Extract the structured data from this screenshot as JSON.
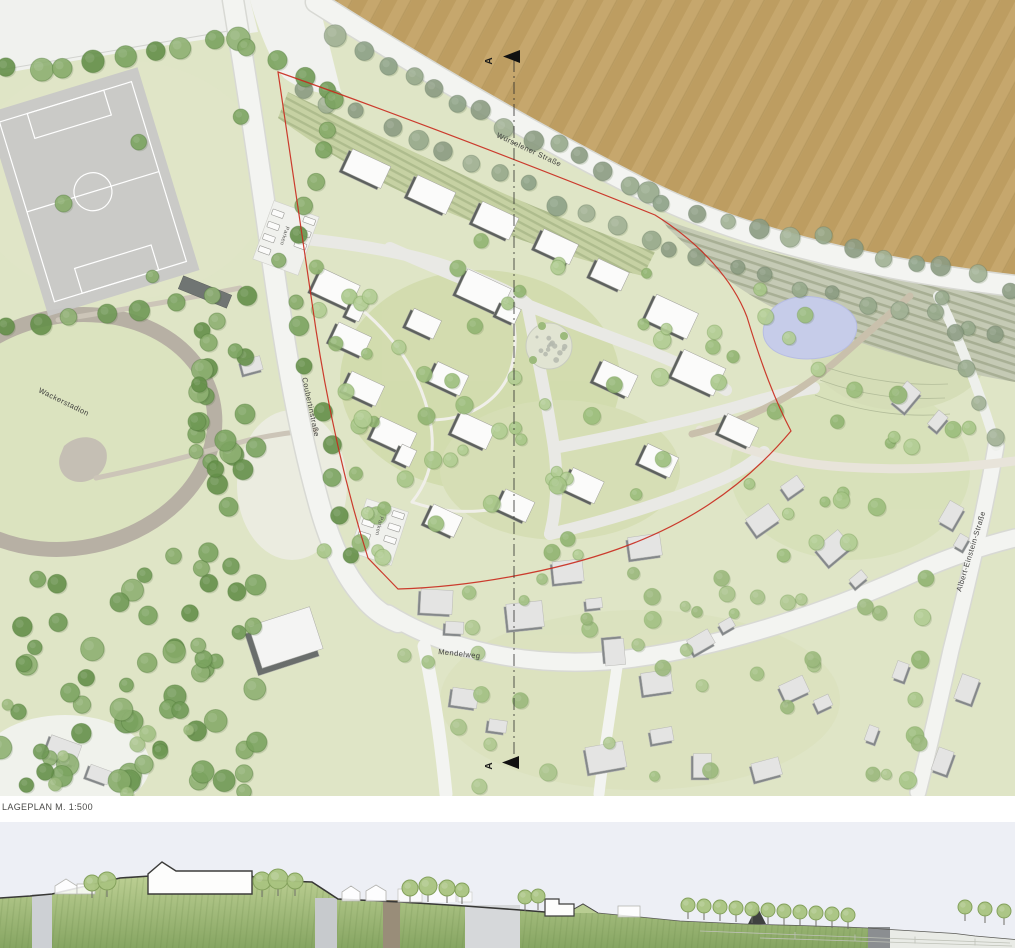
{
  "document": {
    "scale_label": "LAGEPLAN M. 1:500"
  },
  "section_markers": {
    "top": "A",
    "bottom": "A"
  },
  "streets": {
    "top": "Würselener Straße",
    "west": "Coubertinstraße",
    "south": "Mendelweg",
    "east": "Albert-Einstein-Straße"
  },
  "landmarks": {
    "stadium": "Wackerstadion",
    "parking_north": "Parken",
    "parking_south": "Parken"
  },
  "colors": {
    "field": "#c6a76d",
    "pond": "#c6cce9",
    "boundary_red": "#c9281c",
    "forest_green": "#7ba460",
    "site_green": "#ccd8a3",
    "road_white": "#f3f4f1",
    "section_sky": "#edeff5",
    "section_ground_top": "#b9cd90",
    "section_ground_bottom": "#87a763"
  },
  "map": {
    "palettes": {
      "street": {
        "fills": [
          "#8da287",
          "#97aa8c",
          "#a2b295",
          "#8c9c83"
        ],
        "stroke": "#6f7f68"
      },
      "forest": {
        "fills": [
          "#6f9a55",
          "#7ba460",
          "#87ac6a",
          "#649049",
          "#90b273"
        ],
        "stroke": "#4f7a3a"
      },
      "site": {
        "fills": [
          "#9cbe7c",
          "#a8c789",
          "#b3ce94",
          "#92b572"
        ],
        "stroke": "#7ba05a"
      },
      "mixed": {
        "fills": [
          "#a3c184",
          "#b0ca92",
          "#9cba7d",
          "#abc58d"
        ],
        "stroke": "#82a763"
      }
    },
    "tree_rows": [
      {
        "line": [
          340,
          40,
          652,
          196
        ],
        "n": 14,
        "r": [
          8,
          11
        ],
        "pal": "street",
        "j": 5
      },
      {
        "line": [
          664,
          202,
          1008,
          286
        ],
        "n": 12,
        "r": [
          7,
          10
        ],
        "pal": "street",
        "j": 5
      },
      {
        "line": [
          302,
          86,
          648,
          240
        ],
        "n": 13,
        "r": [
          7,
          10
        ],
        "pal": "street",
        "j": 6
      },
      {
        "line": [
          668,
          252,
          1000,
          332
        ],
        "n": 11,
        "r": [
          6,
          9
        ],
        "pal": "street",
        "j": 6
      },
      {
        "line": [
          8,
          70,
          238,
          40
        ],
        "n": 9,
        "r": [
          9,
          12
        ],
        "pal": "forest",
        "j": 6
      },
      {
        "line": [
          246,
          44,
          330,
          88
        ],
        "n": 4,
        "r": [
          8,
          10
        ],
        "pal": "forest",
        "j": 4
      },
      {
        "line": [
          330,
          102,
          302,
          232
        ],
        "n": 6,
        "r": [
          8,
          10
        ],
        "pal": "forest",
        "j": 5
      },
      {
        "line": [
          2,
          332,
          242,
          296
        ],
        "n": 8,
        "r": [
          8,
          11
        ],
        "pal": "forest",
        "j": 6
      },
      {
        "line": [
          284,
          260,
          352,
          552
        ],
        "n": 9,
        "r": [
          7,
          10
        ],
        "pal": "forest",
        "j": 8
      },
      {
        "line": [
          316,
          268,
          378,
          556
        ],
        "n": 8,
        "r": [
          6,
          9
        ],
        "pal": "site",
        "j": 8
      },
      {
        "line": [
          940,
          300,
          996,
          436
        ],
        "n": 5,
        "r": [
          7,
          9
        ],
        "pal": "street",
        "j": 4
      },
      {
        "line": [
          925,
          575,
          905,
          780
        ],
        "n": 6,
        "r": [
          7,
          9
        ],
        "pal": "site",
        "j": 6
      }
    ],
    "tree_clusters": [
      {
        "box": [
          196,
          298,
          64,
          215
        ],
        "n": 24,
        "r": [
          7,
          11
        ],
        "pal": "forest"
      },
      {
        "box": [
          0,
          548,
          258,
          244
        ],
        "n": 66,
        "r": [
          7,
          12
        ],
        "pal": "forest"
      },
      {
        "box": [
          310,
          240,
          440,
          320
        ],
        "n": 52,
        "r": [
          5,
          9
        ],
        "pal": "site"
      },
      {
        "box": [
          700,
          280,
          160,
          120
        ],
        "n": 9,
        "r": [
          5,
          8
        ],
        "pal": "site"
      },
      {
        "box": [
          770,
          390,
          235,
          175
        ],
        "n": 16,
        "r": [
          5,
          9
        ],
        "pal": "site"
      },
      {
        "box": [
          390,
          565,
          550,
          225
        ],
        "n": 42,
        "r": [
          5,
          9
        ],
        "pal": "mixed"
      },
      {
        "box": [
          30,
          100,
          240,
          180
        ],
        "n": 4,
        "r": [
          6,
          9
        ],
        "pal": "forest"
      },
      {
        "box": [
          0,
          700,
          190,
          95
        ],
        "n": 7,
        "r": [
          5,
          8
        ],
        "pal": "mixed"
      }
    ],
    "buildings_new": [
      [
        363,
        170,
        42,
        24,
        25
      ],
      [
        428,
        196,
        42,
        24,
        25
      ],
      [
        492,
        222,
        40,
        24,
        25
      ],
      [
        553,
        248,
        38,
        22,
        25
      ],
      [
        606,
        276,
        34,
        20,
        25
      ],
      [
        332,
        290,
        42,
        26,
        25
      ],
      [
        347,
        341,
        36,
        22,
        25
      ],
      [
        360,
        390,
        36,
        22,
        25
      ],
      [
        390,
        437,
        40,
        24,
        25
      ],
      [
        480,
        293,
        48,
        28,
        25
      ],
      [
        505,
        314,
        20,
        16,
        25
      ],
      [
        420,
        325,
        30,
        20,
        25
      ],
      [
        445,
        380,
        34,
        22,
        25
      ],
      [
        470,
        432,
        38,
        24,
        25
      ],
      [
        402,
        457,
        16,
        18,
        25
      ],
      [
        352,
        313,
        14,
        16,
        25
      ],
      [
        612,
        380,
        38,
        24,
        25
      ],
      [
        668,
        318,
        46,
        28,
        25
      ],
      [
        695,
        374,
        46,
        30,
        25
      ],
      [
        735,
        432,
        34,
        22,
        25
      ],
      [
        655,
        462,
        34,
        22,
        25
      ],
      [
        580,
        487,
        34,
        24,
        25
      ],
      [
        512,
        507,
        32,
        22,
        25
      ],
      [
        440,
        522,
        32,
        22,
        25
      ]
    ],
    "buildings_existing": [
      [
        434,
        604,
        32,
        24,
        3
      ],
      [
        452,
        630,
        18,
        12,
        3
      ],
      [
        523,
        618,
        36,
        26,
        -6
      ],
      [
        566,
        574,
        30,
        22,
        -6
      ],
      [
        592,
        606,
        16,
        10,
        -6
      ],
      [
        643,
        549,
        32,
        22,
        -8
      ],
      [
        612,
        650,
        26,
        20,
        85
      ],
      [
        655,
        685,
        30,
        22,
        -8
      ],
      [
        604,
        760,
        38,
        26,
        -10
      ],
      [
        660,
        738,
        22,
        14,
        -10
      ],
      [
        700,
        645,
        24,
        16,
        -30
      ],
      [
        726,
        628,
        14,
        10,
        -30
      ],
      [
        762,
        523,
        28,
        20,
        -35
      ],
      [
        792,
        490,
        20,
        14,
        -35
      ],
      [
        833,
        551,
        30,
        22,
        -40
      ],
      [
        858,
        582,
        16,
        10,
        -40
      ],
      [
        793,
        692,
        26,
        18,
        -25
      ],
      [
        822,
        706,
        16,
        12,
        -25
      ],
      [
        906,
        400,
        26,
        18,
        -50
      ],
      [
        938,
        424,
        18,
        12,
        -50
      ],
      [
        952,
        518,
        24,
        16,
        -60
      ],
      [
        962,
        545,
        14,
        10,
        -60
      ],
      [
        968,
        692,
        26,
        18,
        -70
      ],
      [
        902,
        674,
        18,
        12,
        -70
      ],
      [
        60,
        752,
        32,
        22,
        20
      ],
      [
        96,
        776,
        22,
        14,
        20
      ],
      [
        944,
        764,
        24,
        16,
        -70
      ],
      [
        873,
        737,
        16,
        10,
        -70
      ],
      [
        462,
        700,
        26,
        18,
        8
      ],
      [
        495,
        728,
        18,
        12,
        8
      ],
      [
        765,
        772,
        28,
        18,
        -15
      ],
      [
        700,
        768,
        18,
        24,
        0
      ],
      [
        282,
        645,
        64,
        44,
        -18,
        "hall"
      ],
      [
        205,
        292,
        52,
        14,
        22,
        "dark"
      ],
      [
        250,
        368,
        20,
        14,
        -15
      ]
    ],
    "parking_lots": [
      {
        "cx": 286,
        "cy": 238,
        "w": 48,
        "h": 62,
        "rot": 20,
        "cars": [
          [
            270,
            218
          ],
          [
            270,
            231
          ],
          [
            270,
            244
          ],
          [
            270,
            257
          ],
          [
            302,
            214
          ],
          [
            302,
            227
          ],
          [
            302,
            240
          ]
        ]
      },
      {
        "cx": 379,
        "cy": 532,
        "w": 44,
        "h": 56,
        "rot": 18,
        "cars": [
          [
            366,
            514
          ],
          [
            366,
            527
          ],
          [
            366,
            540
          ],
          [
            392,
            510
          ],
          [
            392,
            523
          ],
          [
            392,
            536
          ]
        ]
      }
    ],
    "playground": {
      "cx": 549,
      "cy": 346,
      "r": 17,
      "count": 14
    },
    "section_trees": [
      [
        92,
        883,
        8
      ],
      [
        107,
        881,
        9
      ],
      [
        262,
        881,
        9
      ],
      [
        278,
        879,
        10
      ],
      [
        295,
        881,
        8
      ],
      [
        410,
        888,
        8
      ],
      [
        428,
        886,
        9
      ],
      [
        447,
        888,
        8
      ],
      [
        462,
        890,
        7
      ],
      [
        525,
        897,
        7
      ],
      [
        538,
        896,
        7
      ],
      [
        688,
        905,
        7
      ],
      [
        704,
        906,
        7
      ],
      [
        720,
        907,
        7
      ],
      [
        736,
        908,
        7
      ],
      [
        752,
        909,
        7
      ],
      [
        768,
        910,
        7
      ],
      [
        784,
        911,
        7
      ],
      [
        800,
        912,
        7
      ],
      [
        816,
        913,
        7
      ],
      [
        832,
        914,
        7
      ],
      [
        848,
        915,
        7
      ],
      [
        965,
        907,
        7
      ],
      [
        985,
        909,
        7
      ],
      [
        1004,
        911,
        7
      ]
    ]
  }
}
